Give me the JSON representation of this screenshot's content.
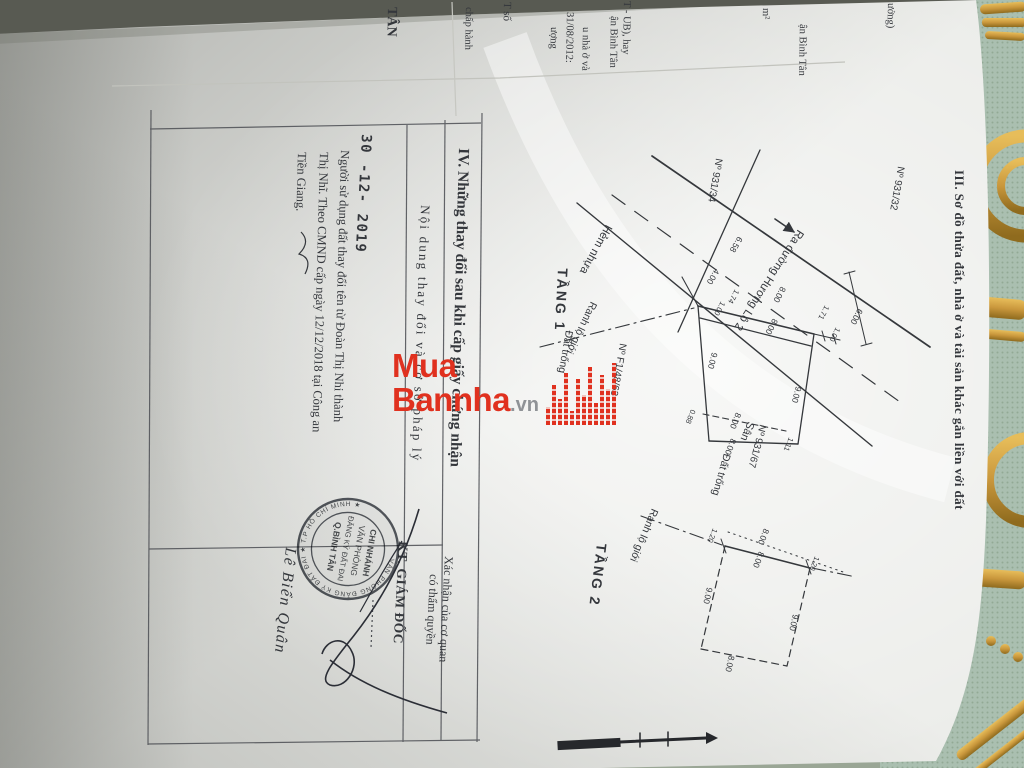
{
  "watermark": {
    "line1": "Mua",
    "line2": "Bannha",
    "suffix": ".vn"
  },
  "colors": {
    "logo_red": "#e0311f",
    "ink": "#34373c",
    "stamp": "#41454d",
    "paper": "#ecedea",
    "fabric": "#aabfb0",
    "gold": "#c9973c"
  },
  "edge_fragments": [
    "ưởng)",
    "ận Bình Tân",
    "m²",
    "T - UB), hay",
    "ận Bình Tân",
    "31/08/2012:",
    "u nhà ở và",
    "ượng",
    "T số",
    "chấp hành",
    "TÂN"
  ],
  "section3": {
    "title": "III. Sơ đồ thửa đất, nhà ở và tài sản khác gắn liền với đất",
    "tang1": {
      "label": "TẦNG 1",
      "road_name": "Hẻm nhựa",
      "road_direction": "Ra đường Hương Lộ 2",
      "boundary_label": "Ranh lộ giới",
      "house_no_left": "Nº 931/34",
      "house_no_right": "Nº 931/32",
      "house_no_side": "Nº 931/67",
      "house_no_front": "Nº F1/48/63",
      "label_empty_left": "Đất trống",
      "label_empty_bottom": "Đất trống",
      "label_yard": "Sân",
      "dims": [
        "6.58",
        "4.00",
        "1.74",
        "1.00",
        "8.00",
        "8.00",
        "1.71",
        "1.00",
        "6.00",
        "9.00",
        "9.00",
        "8.00",
        "8.00",
        "0.88",
        "1.11"
      ]
    },
    "tang2": {
      "label": "TẦNG 2",
      "boundary_label": "Ranh lộ giới",
      "dims": [
        "8.00",
        "8.00",
        "1.20",
        "1.20",
        "9.00",
        "9.00",
        "8.00"
      ]
    }
  },
  "section4": {
    "title": "IV. Những thay đổi sau khi cấp giấy chứng nhận",
    "col1_header": "Nội dung thay đổi và cơ sở pháp lý",
    "col2_header_line1": "Xác nhận của cơ quan",
    "col2_header_line2": "có thẩm quyền",
    "entry": {
      "date": "30 -12- 2019",
      "line1": "Người sử dụng đất thay đổi tên từ Đoàn Thị Nhi thành",
      "line2": "Thị Nhĩ. Theo CMND cấp ngày 12/12/2018 tại Công an",
      "line3": "Tiền Giang."
    },
    "approval": {
      "title": "KT. GIÁM ĐỐC",
      "signer": "Lê Biển Quân",
      "stamp": {
        "ring": "VĂN PHÒNG ĐĂNG KÝ ĐẤT ĐAI ★ T.P HỒ CHÍ MINH ★",
        "line1": "CHI NHÁNH",
        "line2": "VĂN PHÒNG",
        "line3": "ĐĂNG KÝ ĐẤT ĐAI",
        "line4": "Q.BÌNH TÂN"
      }
    }
  }
}
